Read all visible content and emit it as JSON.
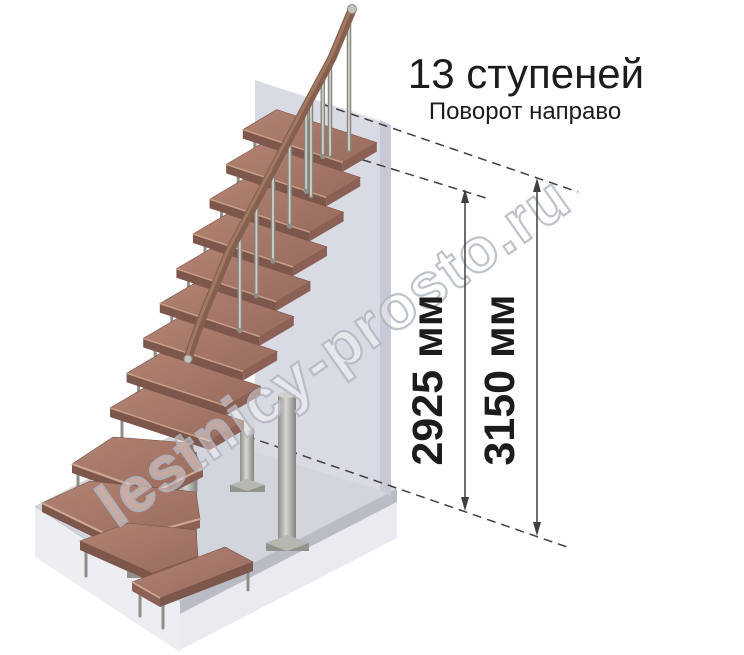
{
  "title": "13 ступеней",
  "subtitle": "Поворот направо",
  "watermark": "lestnicy-prosto.ru",
  "dimensions": {
    "inner": "2925 мм",
    "outer": "3150 мм"
  },
  "colors": {
    "background": "#ffffff",
    "text": "#1c1c1c",
    "line": "#3f3f3f",
    "tread_light": "#b08171",
    "tread_dark": "#996b5e",
    "tread_front": "#7d564c",
    "tread_side": "#8b6055",
    "nosing": "#cfa68e",
    "rail": "#85604f",
    "rail_highlight": "#ab8169",
    "metal": "#cfcfc9",
    "metal_mid": "#b4b4ae",
    "metal_dark": "#8f8f89",
    "wall_face": "#d8dae4",
    "wall_side": "#c7cad6",
    "wall_top": "#eef0f6",
    "floor_top": "#d3d5dd",
    "floor_left": "#eceef2",
    "floor_edge_dark": "#babcc5",
    "floor_edge_light": "#e9ebf0",
    "watermark_stroke": "#b3b8c3"
  }
}
